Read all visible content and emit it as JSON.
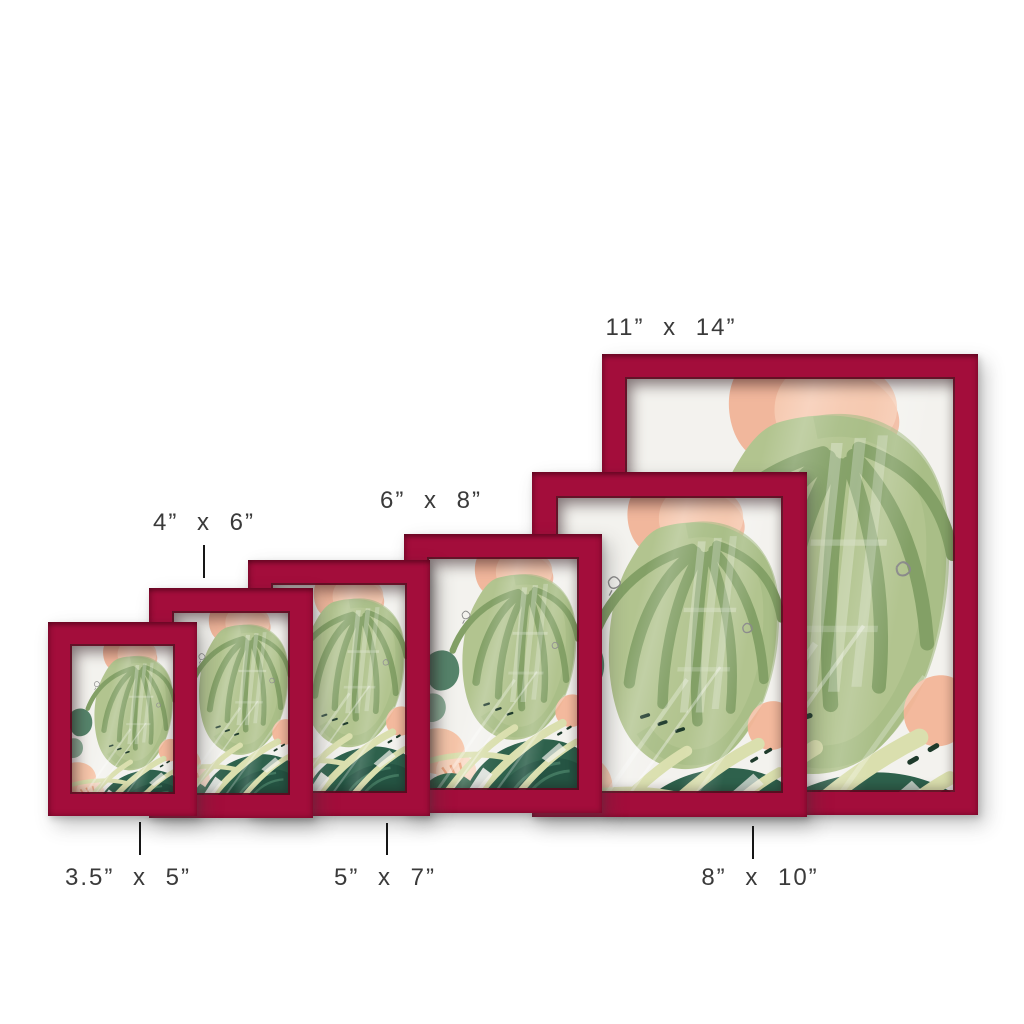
{
  "image": {
    "description": "Six burgundy picture frames with the same tropical watercolor print, arranged front-to-back from smallest to largest, annotated with their sizes",
    "background_color": "#ffffff"
  },
  "colors": {
    "frame_red": "#a30d3b",
    "frame_red_dark": "#6d0824",
    "label_text": "#3a3a3a",
    "tick": "#161616",
    "art_background": "#f3f2ee",
    "art_sage_green": "#b2c48f",
    "art_dark_green_strokes": "#83a066",
    "art_teal": "#2e614c",
    "art_peach": "#f5c2a4",
    "art_stem": "#dadfae"
  },
  "artwork": {
    "name": "tropical-watercolor-botanical-print",
    "elements": "sage green drooping leaves, dark teal foliage, peach flowers, pale stems, glass reflection with window panes"
  },
  "frames": [
    {
      "id": "frame-3.5x5",
      "size": "3.5” x 5”",
      "label_position": "below",
      "has_tick": true
    },
    {
      "id": "frame-4x6",
      "size": "4” x 6”",
      "label_position": "above",
      "has_tick": true
    },
    {
      "id": "frame-5x7",
      "size": "5” x 7”",
      "label_position": "below",
      "has_tick": true
    },
    {
      "id": "frame-6x8",
      "size": "6” x 8”",
      "label_position": "above",
      "has_tick": false
    },
    {
      "id": "frame-8x10",
      "size": "8” x 10”",
      "label_position": "below",
      "has_tick": true
    },
    {
      "id": "frame-11x14",
      "size": "11” x 14”",
      "label_position": "above",
      "has_tick": false
    }
  ]
}
